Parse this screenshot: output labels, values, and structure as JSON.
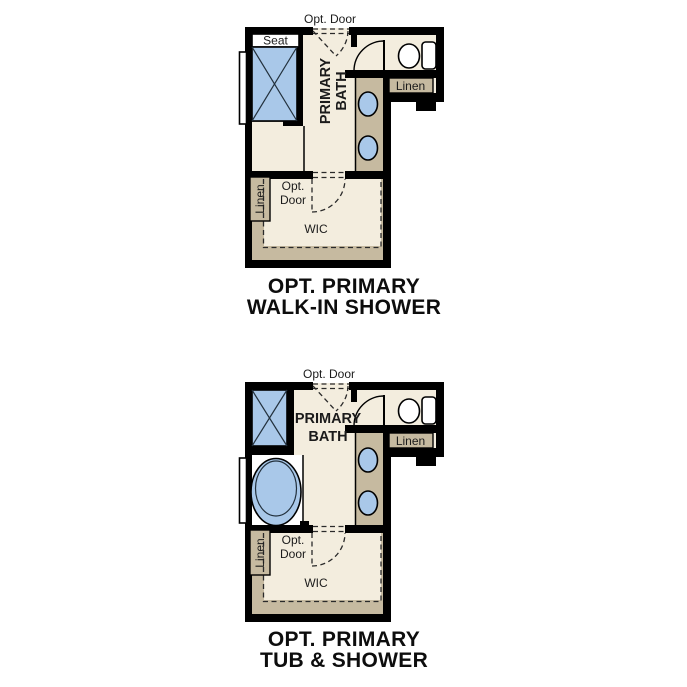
{
  "colors": {
    "floor": "#F3EDDE",
    "cabinet": "#C6BAA0",
    "fixture": "#A9C8E9",
    "wall": "#000000",
    "white": "#FFFFFF",
    "text": "#1B1B1B",
    "caption": "#0D0D0D"
  },
  "plans": [
    {
      "id": "opt-primary-walk-in-shower",
      "caption": [
        "OPT. PRIMARY",
        "WALK-IN SHOWER"
      ],
      "labels": {
        "opt_door_top": "Opt. Door",
        "seat": "Seat",
        "room_line1": "PRIMARY",
        "room_line2": "BATH",
        "linen_right": "Linen",
        "linen_left": "Linen",
        "wic_door_line1": "Opt.",
        "wic_door_line2": "Door",
        "wic": "WIC"
      }
    },
    {
      "id": "opt-primary-tub-and-shower",
      "caption": [
        "OPT. PRIMARY",
        "TUB & SHOWER"
      ],
      "labels": {
        "opt_door_top": "Opt. Door",
        "room_line1": "PRIMARY",
        "room_line2": "BATH",
        "linen_right": "Linen",
        "linen_left": "Linen",
        "wic_door_line1": "Opt.",
        "wic_door_line2": "Door",
        "wic": "WIC"
      }
    }
  ]
}
